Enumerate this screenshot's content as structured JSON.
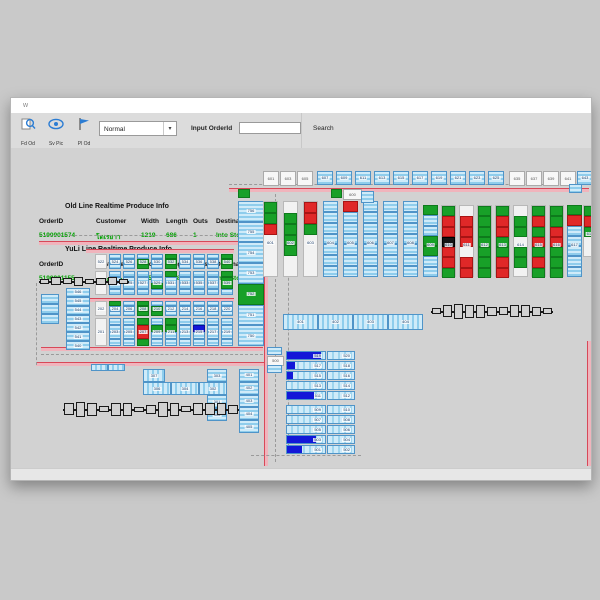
{
  "window": {
    "title": "w",
    "map_tab": "a"
  },
  "toolbar": {
    "buttons": [
      {
        "label": "Fd Od",
        "icon": "find-order-icon"
      },
      {
        "label": "Sv Pic",
        "icon": "eye-icon"
      },
      {
        "label": "Pl Od",
        "icon": "flag-icon"
      }
    ],
    "mode_select": {
      "value": "Normal"
    },
    "order_label": "Input OrderId",
    "input_value": "",
    "search_label": "Search",
    "accent": "#2b7cd3"
  },
  "info_panel": {
    "sections": [
      {
        "title": "Old Line Realtime Produce Info",
        "headers": [
          "OrderID",
          "Customer",
          "Width",
          "Length",
          "Outs",
          "Destination"
        ],
        "row": [
          "5190901574",
          "โตเรยาา",
          "1219",
          "686",
          "1",
          "Into Store P"
        ]
      },
      {
        "title": "YuLi Line Realtime Produce Info",
        "headers": [
          "OrderID",
          "Customer",
          "Width",
          "Length",
          "Outs",
          "Destination"
        ],
        "row": [
          "5190901155",
          "ภ.โตนเจน",
          "505",
          "1378",
          "3",
          "Into Store P"
        ]
      }
    ],
    "row_color": "#00a000"
  },
  "colors": {
    "cell_blue": "#8fcdec",
    "cell_green": "#18a028",
    "cell_red": "#e02828",
    "cell_black": "#151515",
    "cell_darkblue": "#1418d8",
    "conveyor_red": "#d84858",
    "conveyor_pink": "#f0b4bc",
    "bar_blue": "#1318d8",
    "map_bg": "#d2d2d2"
  },
  "map": {
    "conveyors": [
      {
        "x": 218,
        "y": 90,
        "w": 360,
        "h": 0
      },
      {
        "x": 28,
        "y": 143,
        "w": 224,
        "h": 0
      },
      {
        "x": 75,
        "y": 151,
        "w": 148,
        "h": 0
      },
      {
        "x": 75,
        "y": 200,
        "w": 148,
        "h": 0
      },
      {
        "x": 30,
        "y": 249,
        "w": 222,
        "h": 0
      },
      {
        "x": 25,
        "y": 264,
        "w": 228,
        "h": 0
      },
      {
        "x": 253,
        "y": 152,
        "w": 0,
        "h": 216
      },
      {
        "x": 576,
        "y": 243,
        "w": 0,
        "h": 125
      }
    ],
    "dashes": [
      {
        "x": 218,
        "y": 86,
        "w": 360,
        "h": 0
      },
      {
        "x": 28,
        "y": 137,
        "w": 224,
        "h": 0
      },
      {
        "x": 30,
        "y": 256,
        "w": 222,
        "h": 0
      },
      {
        "x": 240,
        "y": 357,
        "w": 110,
        "h": 0
      },
      {
        "x": 264,
        "y": 96,
        "w": 0,
        "h": 268
      },
      {
        "x": 277,
        "y": 140,
        "w": 0,
        "h": 212
      },
      {
        "x": 580,
        "y": 240,
        "w": 0,
        "h": 128
      },
      {
        "x": 25,
        "y": 185,
        "w": 0,
        "h": 82
      }
    ],
    "top_boxes": [
      {
        "x": 252,
        "label": "601",
        "type": "white"
      },
      {
        "x": 269,
        "label": "603",
        "type": "white"
      },
      {
        "x": 286,
        "label": "605",
        "type": "white"
      },
      {
        "x": 306,
        "label": "607",
        "type": "blue"
      },
      {
        "x": 325,
        "label": "609",
        "type": "blue"
      },
      {
        "x": 344,
        "label": "611",
        "type": "blue"
      },
      {
        "x": 363,
        "label": "613",
        "type": "blue"
      },
      {
        "x": 382,
        "label": "615",
        "type": "blue"
      },
      {
        "x": 401,
        "label": "617",
        "type": "blue"
      },
      {
        "x": 420,
        "label": "619",
        "type": "blue"
      },
      {
        "x": 439,
        "label": "621",
        "type": "blue"
      },
      {
        "x": 458,
        "label": "623",
        "type": "blue"
      },
      {
        "x": 477,
        "label": "625",
        "type": "blue"
      },
      {
        "x": 498,
        "label": "635",
        "type": "white"
      },
      {
        "x": 515,
        "label": "637",
        "type": "white"
      },
      {
        "x": 532,
        "label": "639",
        "type": "white"
      },
      {
        "x": 549,
        "label": "641",
        "type": "white"
      },
      {
        "x": 566,
        "label": "643",
        "type": "blue"
      }
    ],
    "tall_rack": {
      "x": 227,
      "y": 103,
      "w": 26,
      "h": 145,
      "labels": [
        "756",
        "755",
        "754",
        "753",
        "752",
        "751",
        "750"
      ],
      "colors": [
        "b",
        "b",
        "b",
        "b",
        "g",
        "b",
        "b"
      ]
    },
    "columns": [
      {
        "x": 252,
        "y": 103,
        "w": 15,
        "h": 76,
        "bg": "white",
        "label": "601",
        "cells": "ggrwwww"
      },
      {
        "x": 272,
        "y": 103,
        "w": 15,
        "h": 76,
        "bg": "white",
        "label": "602",
        "cells": "wggggww"
      },
      {
        "x": 292,
        "y": 103,
        "w": 15,
        "h": 76,
        "bg": "white",
        "label": "603",
        "cells": "rrgwwww"
      },
      {
        "x": 312,
        "y": 103,
        "w": 15,
        "h": 76,
        "bg": "blue",
        "label": "604",
        "cells": "bbbbbbb"
      },
      {
        "x": 332,
        "y": 103,
        "w": 15,
        "h": 76,
        "bg": "blue",
        "label": "605",
        "cells": "rbbbbbb"
      },
      {
        "x": 352,
        "y": 103,
        "w": 15,
        "h": 76,
        "bg": "blue",
        "label": "606",
        "cells": "bbbbbbb"
      },
      {
        "x": 372,
        "y": 103,
        "w": 15,
        "h": 76,
        "bg": "blue",
        "label": "607",
        "cells": "bbbbbbb"
      },
      {
        "x": 392,
        "y": 103,
        "w": 15,
        "h": 76,
        "bg": "blue",
        "label": "608",
        "cells": "bbbbbbb"
      },
      {
        "x": 412,
        "y": 107,
        "w": 15,
        "h": 72,
        "bg": "blue",
        "label": "609",
        "cells": "gbbggbb"
      },
      {
        "x": 430,
        "y": 107,
        "w": 15,
        "h": 72,
        "bg": "white",
        "label": "610",
        "cells": "grrkrrg"
      },
      {
        "x": 448,
        "y": 107,
        "w": 15,
        "h": 72,
        "bg": "white",
        "label": "611",
        "cells": "wrrrwrr"
      },
      {
        "x": 466,
        "y": 107,
        "w": 15,
        "h": 72,
        "bg": "white",
        "label": "612",
        "cells": "ggggggg"
      },
      {
        "x": 484,
        "y": 107,
        "w": 15,
        "h": 72,
        "bg": "white",
        "label": "613",
        "cells": "grrggrr"
      },
      {
        "x": 502,
        "y": 107,
        "w": 15,
        "h": 72,
        "bg": "white",
        "label": "614",
        "cells": "wggwggw"
      },
      {
        "x": 520,
        "y": 107,
        "w": 15,
        "h": 72,
        "bg": "white",
        "label": "615",
        "cells": "grgrgrg"
      },
      {
        "x": 538,
        "y": 107,
        "w": 15,
        "h": 72,
        "bg": "white",
        "label": "616",
        "cells": "ggrrggg"
      },
      {
        "x": 556,
        "y": 107,
        "w": 15,
        "h": 72,
        "bg": "blue",
        "label": "617",
        "cells": "grbbbbb"
      },
      {
        "x": 572,
        "y": 107,
        "w": 14,
        "h": 52,
        "bg": "white",
        "label": "618",
        "cells": "grgww"
      }
    ],
    "banks": [
      {
        "name": "bank-500",
        "top_y": 156,
        "top_h": 15,
        "bot_y": 173,
        "bot_h": 24,
        "cols": [
          {
            "x": 84,
            "white": true,
            "top_label": "522",
            "bot_label": "521",
            "top": "www",
            "bot": "wwww"
          },
          {
            "x": 98,
            "white": false,
            "top_label": "524",
            "bot_label": "523",
            "top": "bbb",
            "bot": "bbbb"
          },
          {
            "x": 112,
            "white": false,
            "top_label": "526",
            "bot_label": "525",
            "top": "bbb",
            "bot": "bbbb"
          },
          {
            "x": 126,
            "white": false,
            "top_label": "528",
            "bot_label": "527",
            "top": "bgg",
            "bot": "bbbb"
          },
          {
            "x": 140,
            "white": false,
            "top_label": "530",
            "bot_label": "529",
            "top": "bbb",
            "bot": "bbgb"
          },
          {
            "x": 154,
            "white": false,
            "top_label": "532",
            "bot_label": "531",
            "top": "ggg",
            "bot": "gbbb"
          },
          {
            "x": 168,
            "white": false,
            "top_label": "534",
            "bot_label": "533",
            "top": "bbb",
            "bot": "bbbb"
          },
          {
            "x": 182,
            "white": false,
            "top_label": "536",
            "bot_label": "535",
            "top": "bbb",
            "bot": "bbbb"
          },
          {
            "x": 196,
            "white": false,
            "top_label": "538",
            "bot_label": "537",
            "top": "bbb",
            "bot": "bbbb"
          },
          {
            "x": 210,
            "white": false,
            "top_label": "540",
            "bot_label": "539",
            "top": "ggg",
            "bot": "gggb"
          }
        ]
      },
      {
        "name": "bank-200",
        "top_y": 203,
        "top_h": 15,
        "bot_y": 220,
        "bot_h": 28,
        "cols": [
          {
            "x": 84,
            "white": true,
            "top_label": "202",
            "bot_label": "201",
            "top": "www",
            "bot": "wwww"
          },
          {
            "x": 98,
            "white": false,
            "top_label": "204",
            "bot_label": "203",
            "top": "gbb",
            "bot": "bbbb"
          },
          {
            "x": 112,
            "white": false,
            "top_label": "206",
            "bot_label": "205",
            "top": "bbb",
            "bot": "bbbb"
          },
          {
            "x": 126,
            "white": false,
            "top_label": "208",
            "bot_label": "207",
            "top": "ggg",
            "bot": "grrg"
          },
          {
            "x": 140,
            "white": false,
            "top_label": "210",
            "bot_label": "209",
            "top": "bgg",
            "bot": "bgbb"
          },
          {
            "x": 154,
            "white": false,
            "top_label": "212",
            "bot_label": "211",
            "top": "bbb",
            "bot": "ggbb"
          },
          {
            "x": 168,
            "white": false,
            "top_label": "214",
            "bot_label": "213",
            "top": "bbb",
            "bot": "bbbb"
          },
          {
            "x": 182,
            "white": false,
            "top_label": "216",
            "bot_label": "215",
            "top": "bbb",
            "bot": "bBbb"
          },
          {
            "x": 196,
            "white": false,
            "top_label": "218",
            "bot_label": "217",
            "top": "bbb",
            "bot": "bbbb"
          },
          {
            "x": 210,
            "white": false,
            "top_label": "220",
            "bot_label": "219",
            "top": "bbb",
            "bot": "bbbb"
          }
        ]
      }
    ],
    "cellboxes": [
      {
        "x": 55,
        "y": 190,
        "w": 24,
        "h": 62,
        "dir": "v",
        "labels": [
          "546",
          "545",
          "544",
          "543",
          "542",
          "541",
          "540"
        ]
      },
      {
        "x": 30,
        "y": 196,
        "w": 18,
        "h": 30,
        "dir": "v",
        "labels": [
          "",
          "",
          ""
        ]
      },
      {
        "x": 272,
        "y": 216,
        "w": 140,
        "h": 16,
        "dir": "h",
        "labels": [
          "401",
          "402",
          "403",
          "404"
        ]
      },
      {
        "x": 132,
        "y": 271,
        "w": 22,
        "h": 13,
        "dir": "h",
        "labels": [
          "307"
        ]
      },
      {
        "x": 132,
        "y": 284,
        "w": 84,
        "h": 13,
        "dir": "h",
        "labels": [
          "306",
          "304",
          "302"
        ]
      },
      {
        "x": 196,
        "y": 271,
        "w": 20,
        "h": 13,
        "dir": "v",
        "labels": [
          "303"
        ]
      },
      {
        "x": 196,
        "y": 297,
        "w": 20,
        "h": 26,
        "dir": "v",
        "labels": [
          "301",
          "300"
        ]
      },
      {
        "x": 228,
        "y": 271,
        "w": 20,
        "h": 64,
        "dir": "v",
        "labels": [
          "401",
          "402",
          "403",
          "404",
          "405"
        ]
      },
      {
        "x": 80,
        "y": 266,
        "w": 34,
        "h": 7,
        "dir": "h",
        "labels": [
          "",
          ""
        ]
      }
    ],
    "lane_table": {
      "x": 275,
      "y": 253,
      "left_w": 40,
      "right_w": 28,
      "row_h": 9,
      "pitch": 10,
      "gap_after_row": 5,
      "gap": 4,
      "rows": [
        {
          "l": "519",
          "r": "520",
          "bar": 0.9
        },
        {
          "l": "517",
          "r": "518",
          "bar": 0.2
        },
        {
          "l": "515",
          "r": "516",
          "bar": 0.15
        },
        {
          "l": "513",
          "r": "514",
          "bar": 0
        },
        {
          "l": "511",
          "r": "512",
          "bar": 0.72
        },
        {
          "l": "509",
          "r": "510",
          "bar": 0
        },
        {
          "l": "507",
          "r": "508",
          "bar": 0
        },
        {
          "l": "505",
          "r": "506",
          "bar": 0
        },
        {
          "l": "503",
          "r": "504",
          "bar": 0.75
        },
        {
          "l": "501",
          "r": "502",
          "bar": 0.4
        }
      ]
    },
    "junctions": [
      {
        "x": 227,
        "y": 91,
        "w": 12,
        "h": 9,
        "c": "g",
        "label": ""
      },
      {
        "x": 320,
        "y": 91,
        "w": 11,
        "h": 9,
        "c": "g",
        "label": ""
      },
      {
        "x": 332,
        "y": 91,
        "w": 17,
        "h": 9,
        "c": "w",
        "label": "600"
      },
      {
        "x": 350,
        "y": 93,
        "w": 13,
        "h": 12,
        "c": "b",
        "label": ""
      },
      {
        "x": 558,
        "y": 86,
        "w": 13,
        "h": 9,
        "c": "b",
        "label": ""
      },
      {
        "x": 256,
        "y": 249,
        "w": 15,
        "h": 8,
        "c": "b",
        "label": ""
      },
      {
        "x": 256,
        "y": 258,
        "w": 15,
        "h": 8,
        "c": "w",
        "label": "500"
      },
      {
        "x": 256,
        "y": 267,
        "w": 15,
        "h": 8,
        "c": "b",
        "label": ""
      }
    ],
    "machines": [
      {
        "x": 28,
        "y": 176,
        "w": 90,
        "h": 14,
        "segs": [
          5,
          8,
          6,
          9,
          5,
          7,
          8,
          5
        ]
      },
      {
        "x": 420,
        "y": 203,
        "w": 122,
        "h": 20,
        "segs": [
          6,
          12,
          15,
          13,
          13,
          9,
          8,
          12,
          12,
          9,
          6
        ]
      },
      {
        "x": 52,
        "y": 300,
        "w": 176,
        "h": 22,
        "segs": [
          12,
          15,
          13,
          6,
          13,
          13,
          5,
          9,
          15,
          13,
          6,
          12,
          12,
          12,
          9
        ]
      }
    ]
  }
}
